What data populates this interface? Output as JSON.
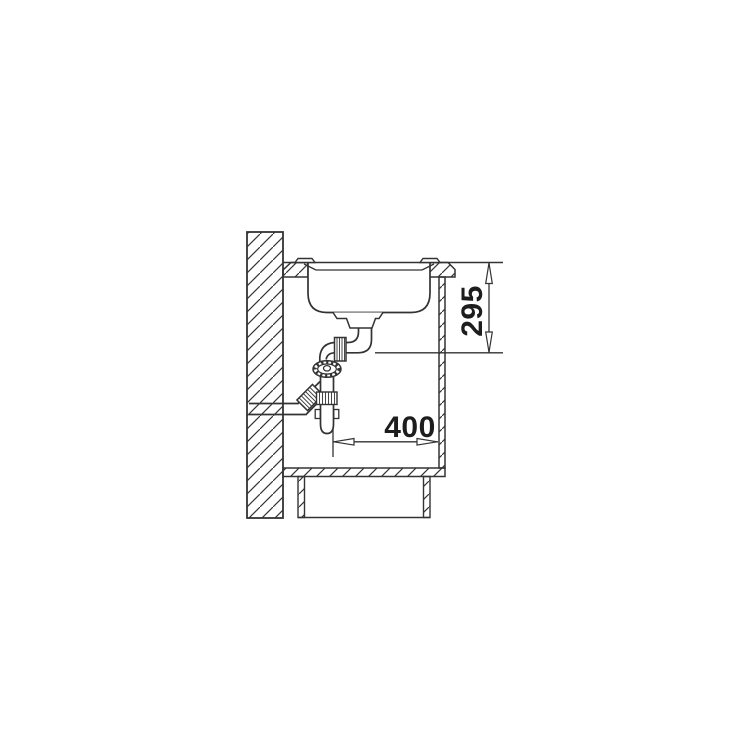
{
  "drawing": {
    "background": "#ffffff",
    "line_color": "#333333",
    "dimensions": {
      "vertical": "295",
      "horizontal": "400"
    }
  }
}
